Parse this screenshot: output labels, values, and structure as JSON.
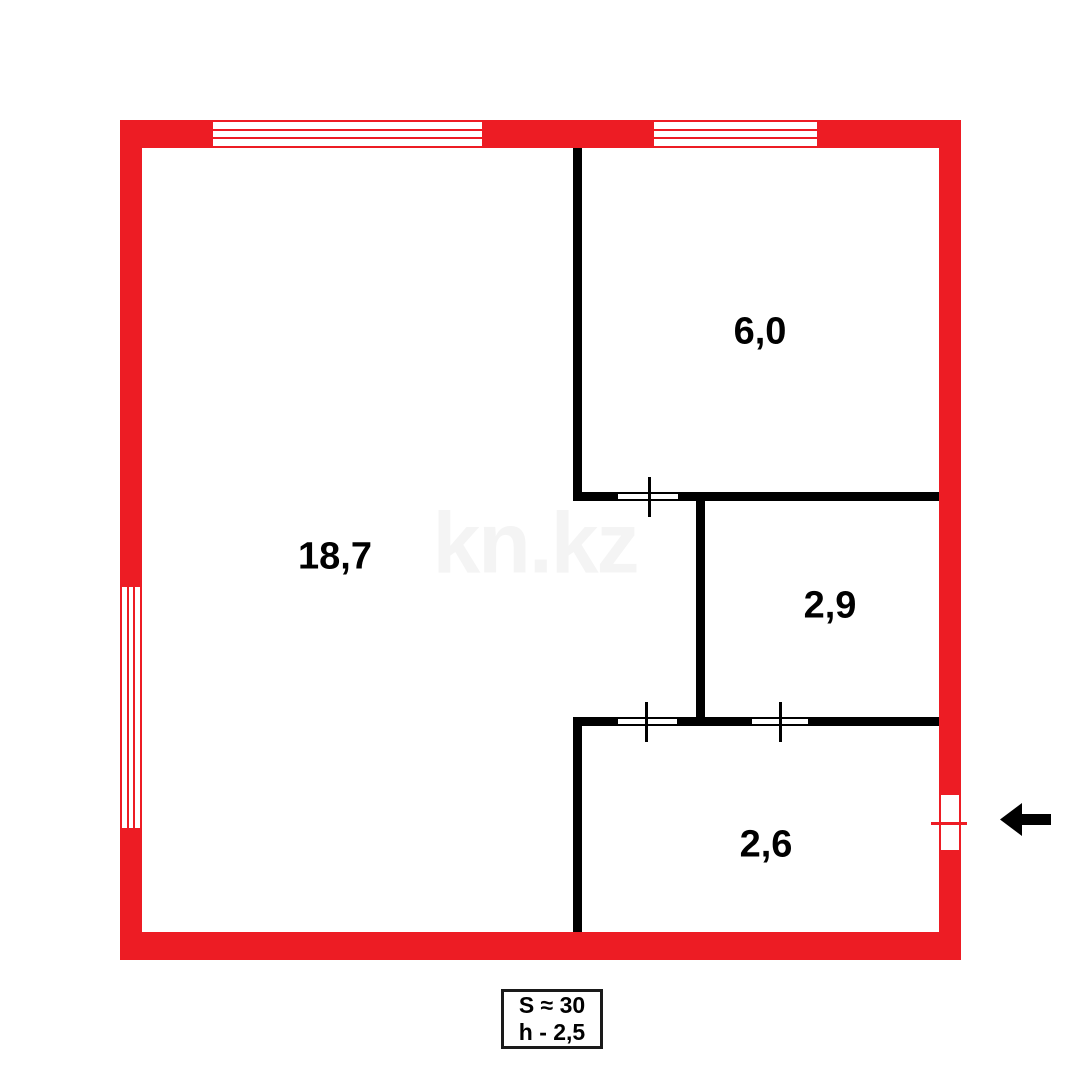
{
  "watermark": "kn.kz",
  "rooms": [
    {
      "area": "18,7"
    },
    {
      "area": "6,0"
    },
    {
      "area": "2,9"
    },
    {
      "area": "2,6"
    }
  ],
  "info_box": {
    "total_area": "S ≈ 30",
    "ceiling_height": "h - 2,5"
  },
  "colors": {
    "wall_red": "#ED1C24",
    "wall_black": "#000000",
    "watermark_gray": "#F4F4F4"
  },
  "icons": {
    "entrance_arrow": "left-arrow"
  }
}
